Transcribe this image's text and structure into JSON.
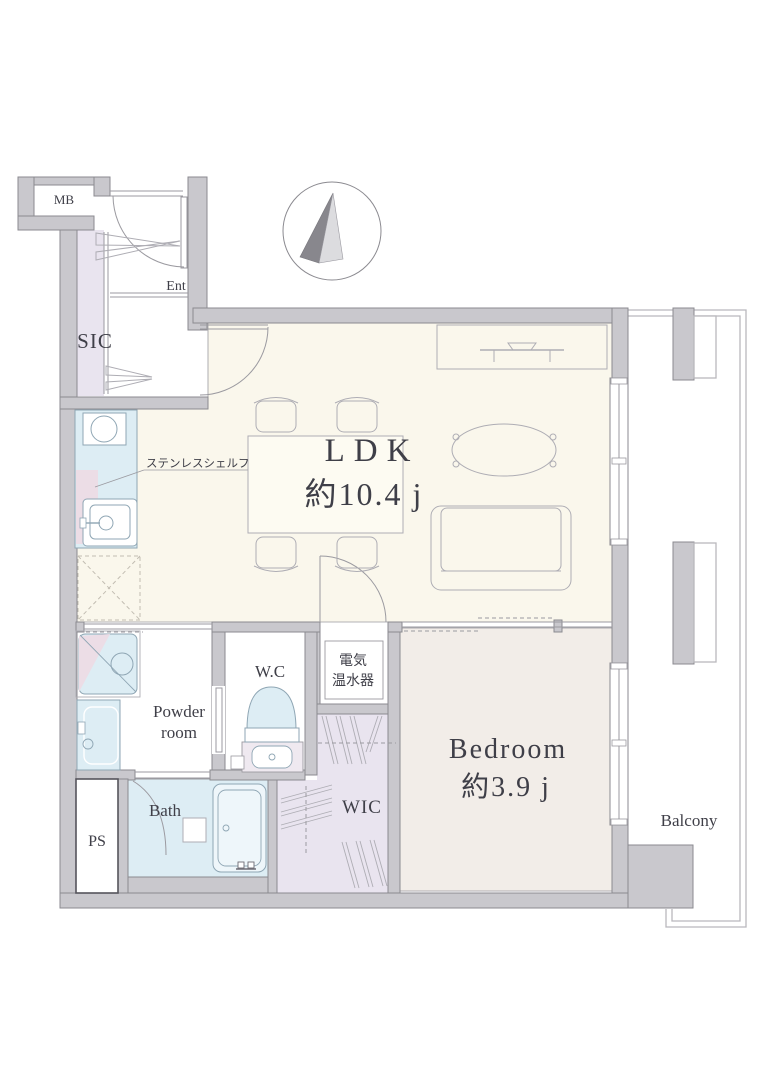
{
  "plan_title": "1LDK apartment floor plan",
  "labels": {
    "mb": "MB",
    "ent": "Ent",
    "sic": "SIC",
    "ldk": "LDK",
    "ldk_size": "約10.4 j",
    "shelf_note": "ステンレスシェルフ",
    "wc": "W.C",
    "heater_line1": "電気",
    "heater_line2": "温水器",
    "powder_line1": "Powder",
    "powder_line2": "room",
    "bath": "Bath",
    "ps": "PS",
    "wic": "WIC",
    "bedroom": "Bedroom",
    "bedroom_size": "約3.9 j",
    "balcony": "Balcony"
  },
  "icons": {
    "compass": "north-compass-needle"
  },
  "colors": {
    "wall": "#c9c8cd",
    "wall_stroke": "#8b8a90",
    "floor_ldk": "#faf7ec",
    "floor_bedroom": "#f2ede8",
    "fixture_blue": "#ddedf4",
    "fixture_line": "#8fa6b4",
    "closet_lavender": "#e9e4ef",
    "accent_pink": "#ecdde6",
    "line": "#9b9aa0",
    "furn_line": "#aeadb4",
    "fridge_line": "#c2bdb2",
    "balcony_line": "#b9b8bd",
    "text": "#3f3f48"
  }
}
